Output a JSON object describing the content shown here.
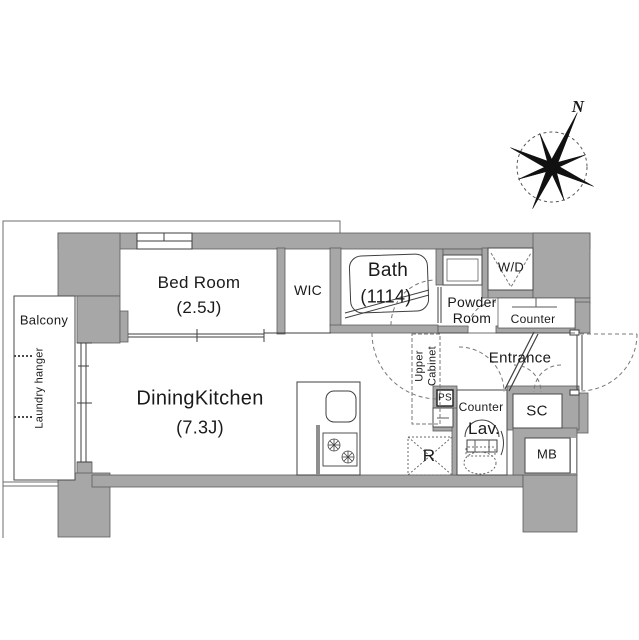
{
  "plan": {
    "compass": {
      "north": "N"
    },
    "rooms": {
      "balcony": "Balcony",
      "laundry_hanger": "Laundry hanger",
      "bedroom": "Bed Room",
      "bedroom_size": "(2.5J)",
      "wic": "WIC",
      "bath": "Bath",
      "bath_size": "(1114)",
      "powder_room": "Powder\nRoom",
      "wd": "W/D",
      "counter_top": "Counter",
      "entrance": "Entrance",
      "upper_cabinet": "Upper\nCabinet",
      "ps": "PS",
      "lav_counter": "Counter",
      "lav": "Lav.",
      "sc": "SC",
      "mb": "MB",
      "refrigerator": "R",
      "dining_kitchen": "DiningKitchen",
      "dining_kitchen_size": "(7.3J)"
    },
    "colors": {
      "wall": "#a7a7a7",
      "line": "#3f3f3f",
      "dash": "#777777"
    }
  }
}
